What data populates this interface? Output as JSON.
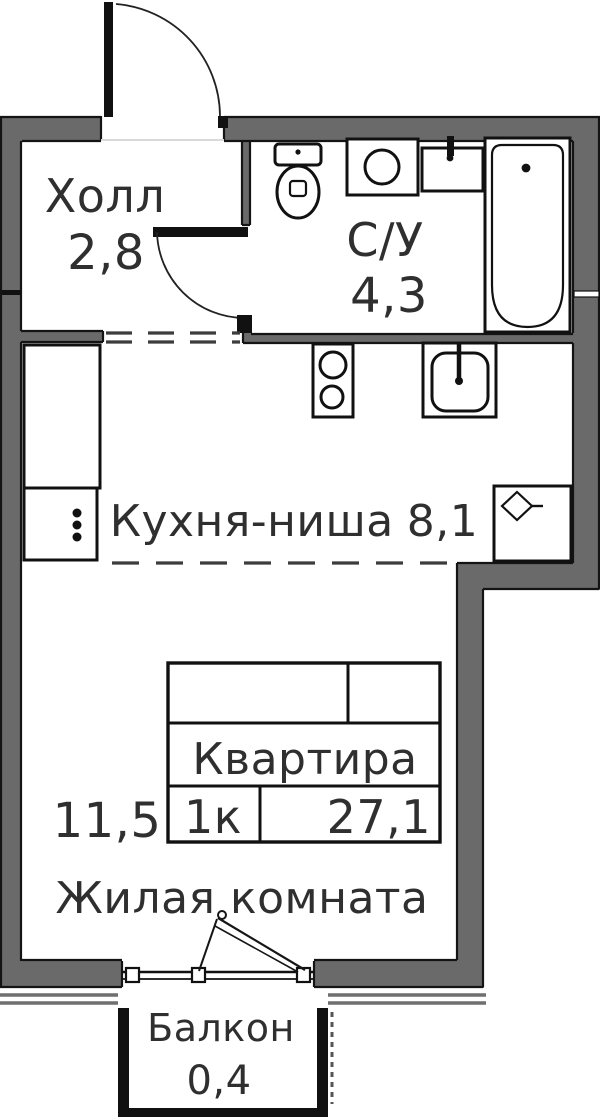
{
  "rooms": {
    "hall": {
      "label": "Холл",
      "area": "2,8"
    },
    "bathroom": {
      "label": "С/У",
      "area": "4,3"
    },
    "kitchen": {
      "label": "Кухня-ниша",
      "area": "8,1"
    },
    "living_room": {
      "label": "Жилая комната",
      "area": "11,5"
    },
    "balcony": {
      "label": "Балкон",
      "area": "0,4"
    }
  },
  "stamp": {
    "name": "Квартира",
    "rooms_count": "1к",
    "total_area": "27,1"
  },
  "colors": {
    "wall": "#6a6a6a",
    "outline": "#141414",
    "text": "#2f2f2f",
    "background": "#ffffff"
  }
}
